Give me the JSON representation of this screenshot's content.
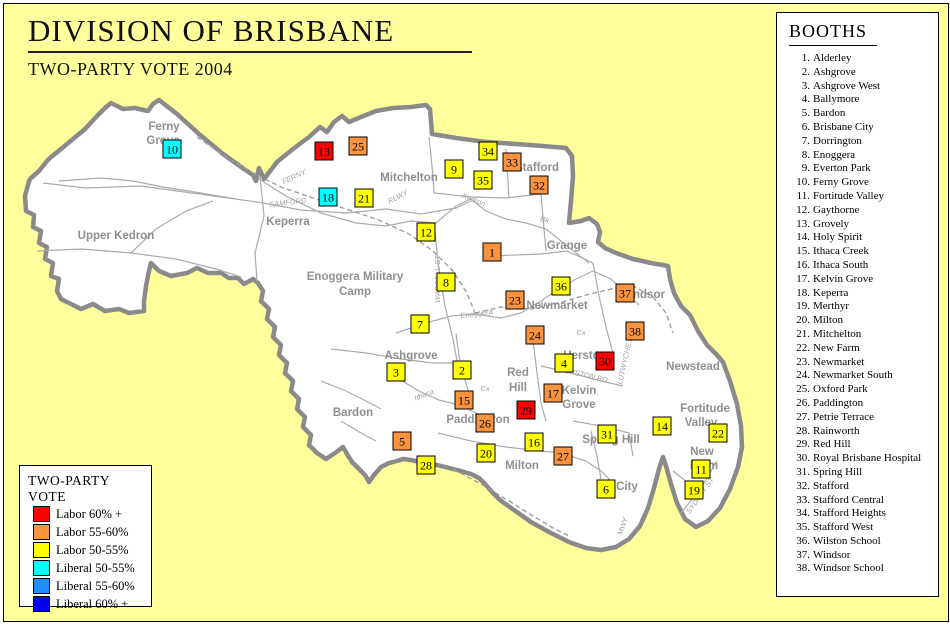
{
  "title": "DIVISION OF BRISBANE",
  "subtitle": "TWO-PARTY VOTE 2004",
  "booths_panel": {
    "title": "BOOTHS",
    "items": [
      "Alderley",
      "Ashgrove",
      "Ashgrove West",
      "Ballymore",
      "Bardon",
      "Brisbane City",
      "Dorrington",
      "Enoggera",
      "Everton Park",
      "Ferny Grove",
      "Fortitude Valley",
      "Gaythorne",
      "Grovely",
      "Holy Spirit",
      "Ithaca Creek",
      "Ithaca South",
      "Kelvin Grove",
      "Keperra",
      "Merthyr",
      "Milton",
      "Mitchelton",
      "New Farm",
      "Newmarket",
      "Newmarket South",
      "Oxford Park",
      "Paddington",
      "Petrie Terrace",
      "Rainworth",
      "Red Hill",
      "Royal Brisbane Hospital",
      "Spring Hill",
      "Stafford",
      "Stafford Central",
      "Stafford Heights",
      "Stafford West",
      "Wilston School",
      "Windsor",
      "Windsor School"
    ]
  },
  "legend": {
    "title": "TWO-PARTY VOTE",
    "entries": [
      {
        "key": "labor60",
        "label": "Labor 60% +",
        "color": "#FF0000"
      },
      {
        "key": "labor55",
        "label": "Labor 55-60%",
        "color": "#FA9441"
      },
      {
        "key": "labor50",
        "label": "Labor 50-55%",
        "color": "#FFFF00"
      },
      {
        "key": "lib50",
        "label": "Liberal 50-55%",
        "color": "#00FFFF"
      },
      {
        "key": "lib55",
        "label": "Liberal 55-60%",
        "color": "#1E90FF"
      },
      {
        "key": "lib60",
        "label": "Liberal 60% +",
        "color": "#0000F0"
      }
    ]
  },
  "map": {
    "colors": {
      "outside": "#FFFF9C",
      "district": "#FFFFFF",
      "boundary": "#8A8A8A",
      "roads": "#ABABAB",
      "suburb_text": "#8F8F8F",
      "small_text": "#A0A0A0"
    },
    "suburb_labels": [
      {
        "text": "Ferny",
        "x": 163,
        "y": 129
      },
      {
        "text": "Grove",
        "x": 162,
        "y": 143
      },
      {
        "text": "Upper Kedron",
        "x": 115,
        "y": 238
      },
      {
        "text": "Keperra",
        "x": 287,
        "y": 224
      },
      {
        "text": "Mitchelton",
        "x": 408,
        "y": 180
      },
      {
        "text": "Stafford",
        "x": 536,
        "y": 170
      },
      {
        "text": "Grange",
        "x": 566,
        "y": 248
      },
      {
        "text": "Enoggera Military",
        "x": 354,
        "y": 279
      },
      {
        "text": "Camp",
        "x": 354,
        "y": 294
      },
      {
        "text": "Newmarket",
        "x": 556,
        "y": 308
      },
      {
        "text": "Windsor",
        "x": 641,
        "y": 297
      },
      {
        "text": "Ashgrove",
        "x": 410,
        "y": 358
      },
      {
        "text": "Red",
        "x": 517,
        "y": 375
      },
      {
        "text": "Hill",
        "x": 517,
        "y": 390
      },
      {
        "text": "Herston",
        "x": 584,
        "y": 358
      },
      {
        "text": "Kelvin",
        "x": 578,
        "y": 393
      },
      {
        "text": "Grove",
        "x": 578,
        "y": 407
      },
      {
        "text": "Newstead",
        "x": 692,
        "y": 369
      },
      {
        "text": "Fortitude",
        "x": 704,
        "y": 411
      },
      {
        "text": "Valley",
        "x": 700,
        "y": 425
      },
      {
        "text": "New",
        "x": 701,
        "y": 454
      },
      {
        "text": "Farm",
        "x": 703,
        "y": 468
      },
      {
        "text": "Spring Hill",
        "x": 610,
        "y": 442
      },
      {
        "text": "Milton",
        "x": 521,
        "y": 468
      },
      {
        "text": "Paddington",
        "x": 477,
        "y": 422
      },
      {
        "text": "Bardon",
        "x": 352,
        "y": 415
      },
      {
        "text": "City",
        "x": 626,
        "y": 489
      }
    ],
    "small_labels": [
      {
        "text": "FERNY",
        "x": 294,
        "y": 178,
        "rot": -25
      },
      {
        "text": "SAMFORD",
        "x": 287,
        "y": 204,
        "rot": -7
      },
      {
        "text": "RLWY",
        "x": 398,
        "y": 198,
        "rot": -28
      },
      {
        "text": "Kedron",
        "x": 472,
        "y": 201,
        "rot": 22
      },
      {
        "text": "Bk",
        "x": 543,
        "y": 221,
        "rot": 15
      },
      {
        "text": "Enoggera",
        "x": 476,
        "y": 315,
        "rot": -8
      },
      {
        "text": "Cx",
        "x": 580,
        "y": 334,
        "rot": 0
      },
      {
        "text": "Cx",
        "x": 484,
        "y": 390,
        "rot": 0
      },
      {
        "text": "Ithaca",
        "x": 424,
        "y": 396,
        "rot": -22
      },
      {
        "text": "WARDELL ST",
        "x": 439,
        "y": 278,
        "rot": -90
      },
      {
        "text": "HERSTON RD",
        "x": 582,
        "y": 376,
        "rot": 13
      },
      {
        "text": "LUTWYCHE RD",
        "x": 627,
        "y": 357,
        "rot": -77
      },
      {
        "text": "SYDNEY ST",
        "x": 701,
        "y": 496,
        "rot": -55
      },
      {
        "text": "MWY",
        "x": 624,
        "y": 526,
        "rot": -70
      }
    ],
    "markers": [
      {
        "num": 1,
        "x": 482,
        "y": 242,
        "cat": "labor55"
      },
      {
        "num": 2,
        "x": 452,
        "y": 360,
        "cat": "labor50"
      },
      {
        "num": 3,
        "x": 386,
        "y": 362,
        "cat": "labor50"
      },
      {
        "num": 4,
        "x": 554,
        "y": 353,
        "cat": "labor50"
      },
      {
        "num": 5,
        "x": 392,
        "y": 431,
        "cat": "labor55"
      },
      {
        "num": 6,
        "x": 596,
        "y": 479,
        "cat": "labor50"
      },
      {
        "num": 7,
        "x": 410,
        "y": 314,
        "cat": "labor50"
      },
      {
        "num": 8,
        "x": 436,
        "y": 272,
        "cat": "labor50"
      },
      {
        "num": 9,
        "x": 444,
        "y": 159,
        "cat": "labor50"
      },
      {
        "num": 10,
        "x": 162,
        "y": 139,
        "cat": "lib50"
      },
      {
        "num": 11,
        "x": 691,
        "y": 459,
        "cat": "labor50"
      },
      {
        "num": 12,
        "x": 416,
        "y": 222,
        "cat": "labor50"
      },
      {
        "num": 13,
        "x": 314,
        "y": 141,
        "cat": "labor60"
      },
      {
        "num": 14,
        "x": 652,
        "y": 416,
        "cat": "labor50"
      },
      {
        "num": 15,
        "x": 454,
        "y": 390,
        "cat": "labor55"
      },
      {
        "num": 16,
        "x": 524,
        "y": 432,
        "cat": "labor50"
      },
      {
        "num": 17,
        "x": 543,
        "y": 383,
        "cat": "labor55"
      },
      {
        "num": 18,
        "x": 318,
        "y": 187,
        "cat": "lib50"
      },
      {
        "num": 19,
        "x": 684,
        "y": 480,
        "cat": "labor50"
      },
      {
        "num": 20,
        "x": 476,
        "y": 443,
        "cat": "labor50"
      },
      {
        "num": 21,
        "x": 354,
        "y": 188,
        "cat": "labor50"
      },
      {
        "num": 22,
        "x": 708,
        "y": 423,
        "cat": "labor50"
      },
      {
        "num": 23,
        "x": 505,
        "y": 290,
        "cat": "labor55"
      },
      {
        "num": 24,
        "x": 525,
        "y": 325,
        "cat": "labor55"
      },
      {
        "num": 25,
        "x": 348,
        "y": 136,
        "cat": "labor55"
      },
      {
        "num": 26,
        "x": 475,
        "y": 413,
        "cat": "labor55"
      },
      {
        "num": 27,
        "x": 553,
        "y": 446,
        "cat": "labor55"
      },
      {
        "num": 28,
        "x": 416,
        "y": 455,
        "cat": "labor50"
      },
      {
        "num": 29,
        "x": 516,
        "y": 400,
        "cat": "labor60"
      },
      {
        "num": 30,
        "x": 595,
        "y": 351,
        "cat": "labor60"
      },
      {
        "num": 31,
        "x": 597,
        "y": 424,
        "cat": "labor50"
      },
      {
        "num": 32,
        "x": 529,
        "y": 175,
        "cat": "labor55"
      },
      {
        "num": 33,
        "x": 502,
        "y": 152,
        "cat": "labor55"
      },
      {
        "num": 34,
        "x": 478,
        "y": 141,
        "cat": "labor50"
      },
      {
        "num": 35,
        "x": 473,
        "y": 170,
        "cat": "labor50"
      },
      {
        "num": 36,
        "x": 551,
        "y": 276,
        "cat": "labor50"
      },
      {
        "num": 37,
        "x": 615,
        "y": 283,
        "cat": "labor55"
      },
      {
        "num": 38,
        "x": 625,
        "y": 321,
        "cat": "labor55"
      }
    ]
  }
}
